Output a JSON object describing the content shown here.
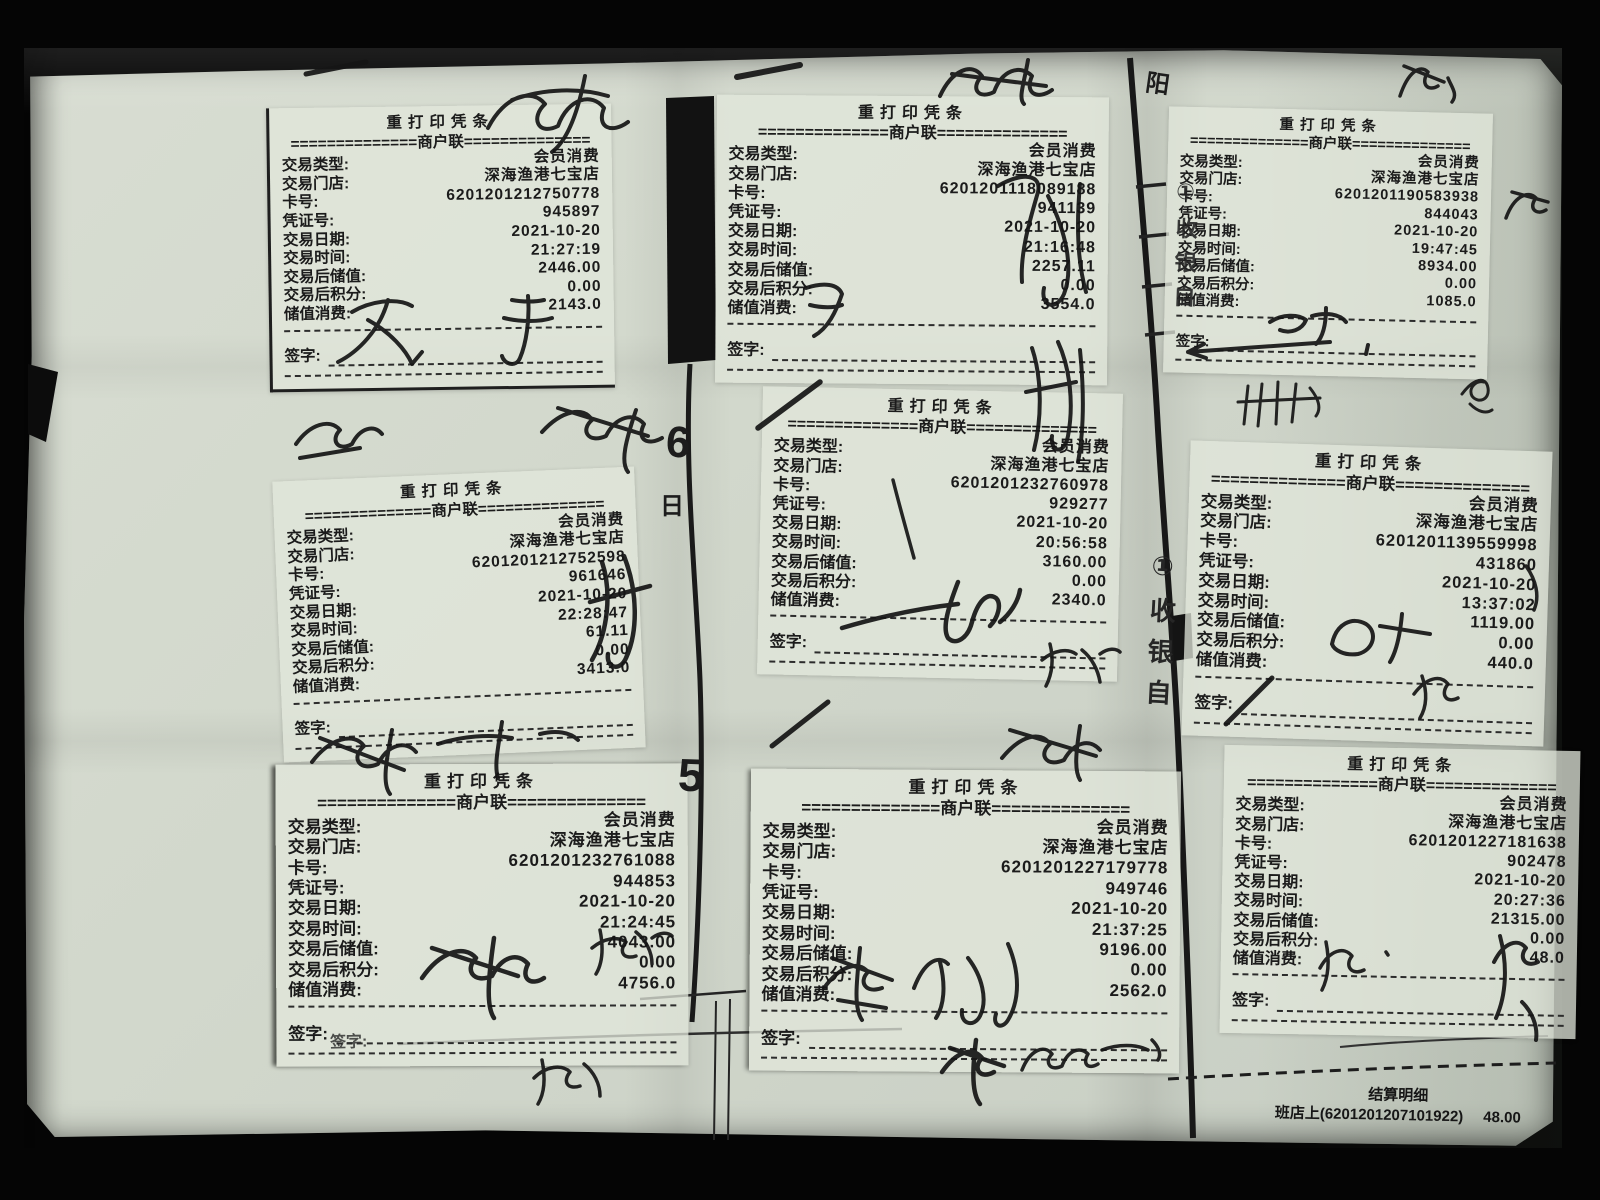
{
  "labels": {
    "title": "重打印凭条",
    "copy_divider": "==============商户联==============",
    "field_type": "交易类型:",
    "field_store": "交易门店:",
    "field_card": "卡号:",
    "field_voucher": "凭证号:",
    "field_date": "交易日期:",
    "field_time": "交易时间:",
    "field_balance": "交易后储值:",
    "field_points": "交易后积分:",
    "field_amount": "储值消费:",
    "field_sign": "签字:"
  },
  "receipts": [
    {
      "type": "会员消费",
      "store": "深海渔港七宝店",
      "card": "6201201212750778",
      "voucher": "945897",
      "date": "2021-10-20",
      "time": "21:27:19",
      "balance": "2446.00",
      "points": "0.00",
      "amount": "2143.0"
    },
    {
      "type": "会员消费",
      "store": "深海渔港七宝店",
      "card": "6201201118089188",
      "voucher": "941139",
      "date": "2021-10-20",
      "time": "21:16:48",
      "balance": "2257.11",
      "points": "0.00",
      "amount": "3554.0"
    },
    {
      "type": "会员消费",
      "store": "深海渔港七宝店",
      "card": "6201201190583938",
      "voucher": "844043",
      "date": "2021-10-20",
      "time": "19:47:45",
      "balance": "8934.00",
      "points": "0.00",
      "amount": "1085.0"
    },
    {
      "type": "会员消费",
      "store": "深海渔港七宝店",
      "card": "6201201212752598",
      "voucher": "961646",
      "date": "2021-10-20",
      "time": "22:28:47",
      "balance": "61.11",
      "points": "0.00",
      "amount": "3413.0"
    },
    {
      "type": "会员消费",
      "store": "深海渔港七宝店",
      "card": "6201201232760978",
      "voucher": "929277",
      "date": "2021-10-20",
      "time": "20:56:58",
      "balance": "3160.00",
      "points": "0.00",
      "amount": "2340.0"
    },
    {
      "type": "会员消费",
      "store": "深海渔港七宝店",
      "card": "6201201139559998",
      "voucher": "431860",
      "date": "2021-10-20",
      "time": "13:37:02",
      "balance": "1119.00",
      "points": "0.00",
      "amount": "440.0"
    },
    {
      "type": "会员消费",
      "store": "深海渔港七宝店",
      "card": "6201201232761088",
      "voucher": "944853",
      "date": "2021-10-20",
      "time": "21:24:45",
      "balance": "4043.00",
      "points": "0.00",
      "amount": "4756.0"
    },
    {
      "type": "会员消费",
      "store": "深海渔港七宝店",
      "card": "6201201227179778",
      "voucher": "949746",
      "date": "2021-10-20",
      "time": "21:37:25",
      "balance": "9196.00",
      "points": "0.00",
      "amount": "2562.0"
    },
    {
      "type": "会员消费",
      "store": "深海渔港七宝店",
      "card": "6201201227181638",
      "voucher": "902478",
      "date": "2021-10-20",
      "time": "20:27:36",
      "balance": "21315.00",
      "points": "0.00",
      "amount": "48.0"
    }
  ],
  "footer": {
    "title": "结算明细",
    "entry": "班店上(6201201207101922)",
    "amount": "48.00"
  },
  "artifacts": {
    "ghost_sign_label": "签字:",
    "edge_char_top": "阳",
    "edge_vertical_text_top": "①收银自",
    "edge_vertical_text_bottom": "①收银自",
    "fold_digit_top": "6",
    "fold_char": "日",
    "fold_digit_bottom": "5"
  }
}
